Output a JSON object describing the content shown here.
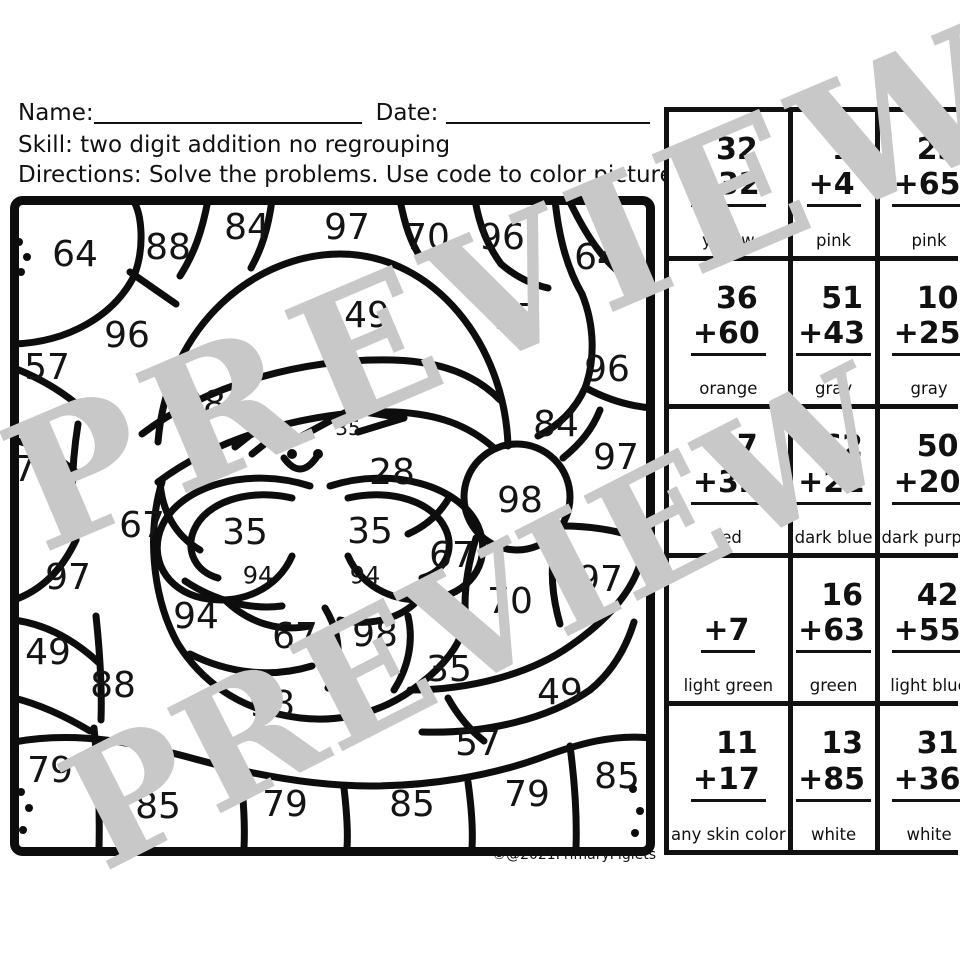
{
  "header": {
    "name_label": "Name:",
    "date_label": "Date:",
    "skill_line": "Skill: two digit addition no regrouping",
    "directions_line": "Directions: Solve the problems. Use code to color picture."
  },
  "credit": "©@2021PrimaryPiglets",
  "watermark": {
    "text": "PREVIEW",
    "color": "#c8c8c8"
  },
  "code_table": {
    "rows": [
      [
        {
          "top": "32",
          "bottom": "+32",
          "color": "yellow"
        },
        {
          "top": "1",
          "bottom": "+4",
          "color": "pink"
        },
        {
          "top": "23",
          "bottom": "+65",
          "color": "pink"
        }
      ],
      [
        {
          "top": "36",
          "bottom": "+60",
          "color": "orange"
        },
        {
          "top": "51",
          "bottom": "+43",
          "color": "gray"
        },
        {
          "top": "10",
          "bottom": "+25",
          "color": "gray"
        }
      ],
      [
        {
          "top": "17",
          "bottom": "+32",
          "color": "red"
        },
        {
          "top": "62",
          "bottom": "+22",
          "color": "dark blue"
        },
        {
          "top": "50",
          "bottom": "+20",
          "color": "dark purple"
        }
      ],
      [
        {
          "top": "",
          "bottom": "+7",
          "color": "light green"
        },
        {
          "top": "16",
          "bottom": "+63",
          "color": "green"
        },
        {
          "top": "42",
          "bottom": "+55",
          "color": "light blue"
        }
      ],
      [
        {
          "top": "11",
          "bottom": "+17",
          "color": "any skin color"
        },
        {
          "top": "13",
          "bottom": "+85",
          "color": "white"
        },
        {
          "top": "31",
          "bottom": "+36",
          "color": "white"
        }
      ]
    ]
  },
  "picture_numbers": [
    {
      "t": "64",
      "x": 65,
      "y": 57
    },
    {
      "t": "88",
      "x": 158,
      "y": 50
    },
    {
      "t": "84",
      "x": 237,
      "y": 30
    },
    {
      "t": "97",
      "x": 337,
      "y": 30
    },
    {
      "t": "70",
      "x": 417,
      "y": 40
    },
    {
      "t": "96",
      "x": 492,
      "y": 40
    },
    {
      "t": "64",
      "x": 587,
      "y": 60
    },
    {
      "t": "96",
      "x": 117,
      "y": 138
    },
    {
      "t": "57",
      "x": 37,
      "y": 170
    },
    {
      "t": "49",
      "x": 357,
      "y": 118
    },
    {
      "t": "57",
      "x": 507,
      "y": 120
    },
    {
      "t": "96",
      "x": 597,
      "y": 172
    },
    {
      "t": "98",
      "x": 193,
      "y": 207
    },
    {
      "t": "35",
      "x": 338,
      "y": 232,
      "s": 20
    },
    {
      "t": "28",
      "x": 382,
      "y": 275
    },
    {
      "t": "84",
      "x": 546,
      "y": 227
    },
    {
      "t": "97",
      "x": 606,
      "y": 260
    },
    {
      "t": "70",
      "x": 26,
      "y": 272
    },
    {
      "t": "67",
      "x": 132,
      "y": 328
    },
    {
      "t": "35",
      "x": 235,
      "y": 335
    },
    {
      "t": "35",
      "x": 360,
      "y": 334
    },
    {
      "t": "98",
      "x": 510,
      "y": 303
    },
    {
      "t": "67",
      "x": 442,
      "y": 358
    },
    {
      "t": "94",
      "x": 248,
      "y": 379,
      "s": 24
    },
    {
      "t": "94",
      "x": 355,
      "y": 379,
      "s": 24
    },
    {
      "t": "97",
      "x": 58,
      "y": 380
    },
    {
      "t": "97",
      "x": 590,
      "y": 382
    },
    {
      "t": "70",
      "x": 500,
      "y": 404
    },
    {
      "t": "94",
      "x": 186,
      "y": 419
    },
    {
      "t": "67",
      "x": 285,
      "y": 439
    },
    {
      "t": "49",
      "x": 38,
      "y": 455
    },
    {
      "t": "88",
      "x": 103,
      "y": 488
    },
    {
      "t": "98",
      "x": 365,
      "y": 437
    },
    {
      "t": "98",
      "x": 262,
      "y": 507
    },
    {
      "t": "35",
      "x": 439,
      "y": 472
    },
    {
      "t": "49",
      "x": 550,
      "y": 495
    },
    {
      "t": "57",
      "x": 468,
      "y": 546
    },
    {
      "t": "79",
      "x": 40,
      "y": 573
    },
    {
      "t": "85",
      "x": 148,
      "y": 609
    },
    {
      "t": "79",
      "x": 275,
      "y": 607
    },
    {
      "t": "85",
      "x": 402,
      "y": 607
    },
    {
      "t": "79",
      "x": 517,
      "y": 597
    },
    {
      "t": "85",
      "x": 607,
      "y": 579
    }
  ]
}
